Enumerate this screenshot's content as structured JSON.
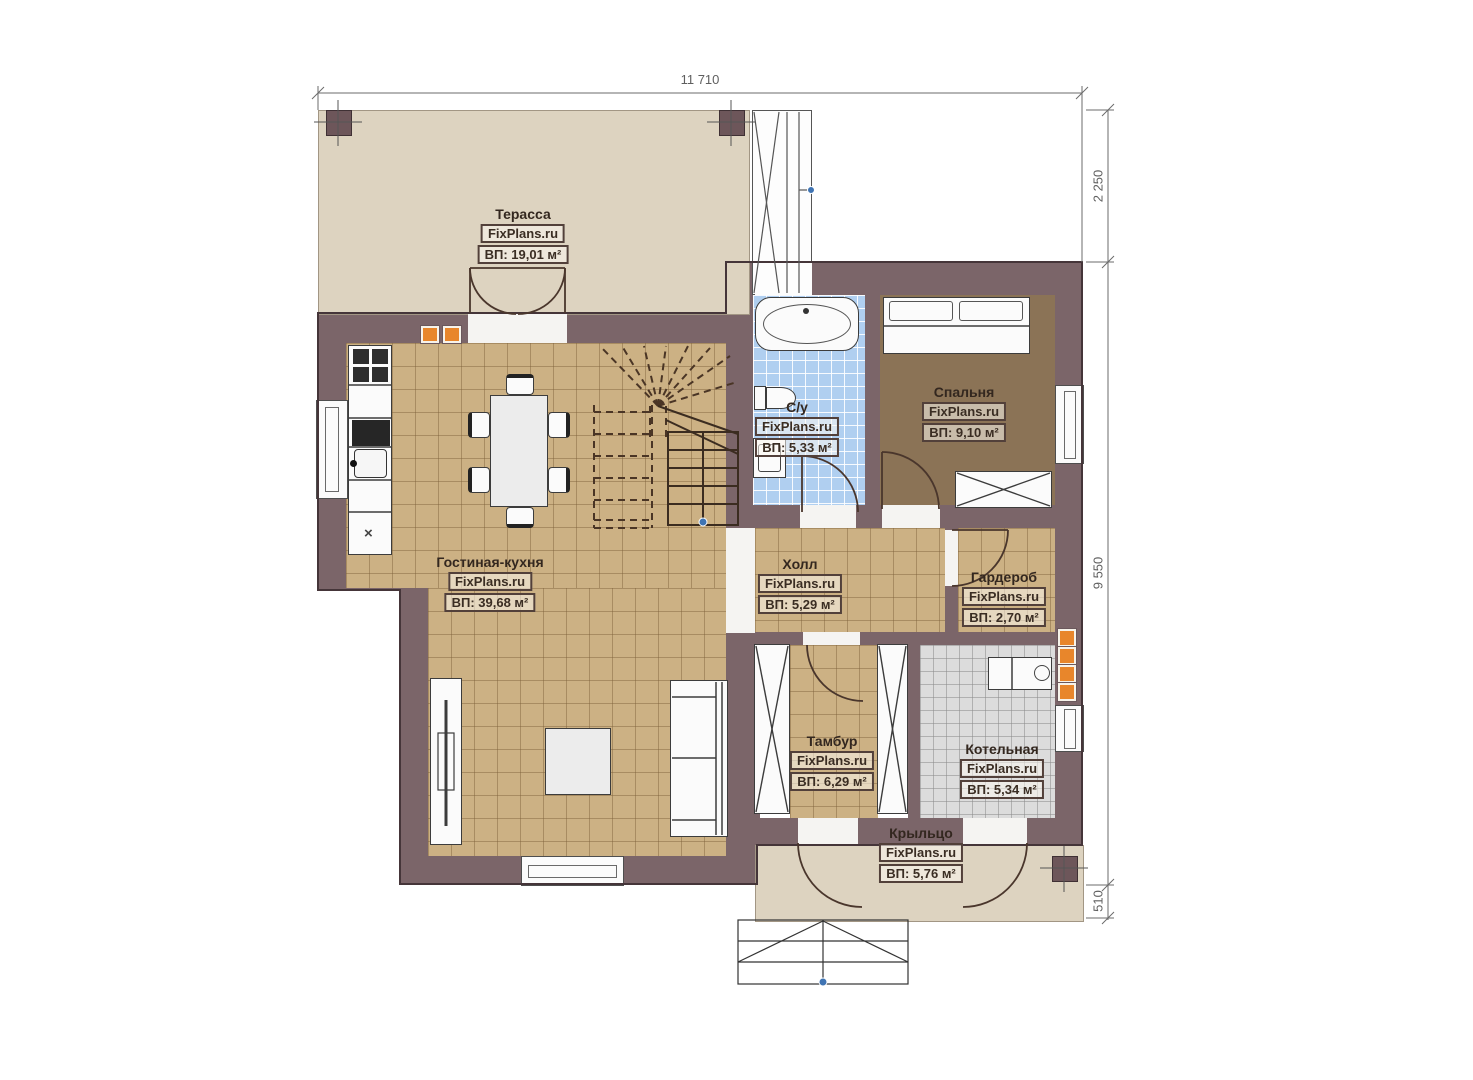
{
  "plan": {
    "watermark": "FixPlans.ru",
    "type_note": "floor plan"
  },
  "dimensions": {
    "top": "11 710",
    "right_upper": "2 250",
    "right_main": "9 550",
    "right_lower": "510"
  },
  "rooms": {
    "terrace": {
      "name": "Терасса",
      "area": "ВП: 19,01 м²"
    },
    "living": {
      "name": "Гостиная-кухня",
      "area": "ВП: 39,68 м²"
    },
    "bathroom": {
      "name": "С/у",
      "area": "ВП: 5,33 м²"
    },
    "bedroom": {
      "name": "Спальня",
      "area": "ВП: 9,10 м²"
    },
    "hall": {
      "name": "Холл",
      "area": "ВП: 5,29 м²"
    },
    "wardrobe": {
      "name": "Гардероб",
      "area": "ВП: 2,70 м²"
    },
    "vestibule": {
      "name": "Тамбур",
      "area": "ВП: 6,29 м²"
    },
    "boiler": {
      "name": "Котельная",
      "area": "ВП: 5,34 м²"
    },
    "porch": {
      "name": "Крыльцо",
      "area": "ВП: 5,76 м²"
    }
  },
  "symbols": {
    "washer_mark": "×"
  },
  "colors": {
    "wall": "#7b6569",
    "floor_tile": "#ccb184",
    "bedroom_floor": "#8b7356",
    "bathroom_tile": "#b0cff0",
    "boiler_tile": "#dcdcdc",
    "terrace_floor": "#ddd3c0",
    "flue_accent": "#e8862b",
    "marker_blue": "#3f74b3"
  }
}
